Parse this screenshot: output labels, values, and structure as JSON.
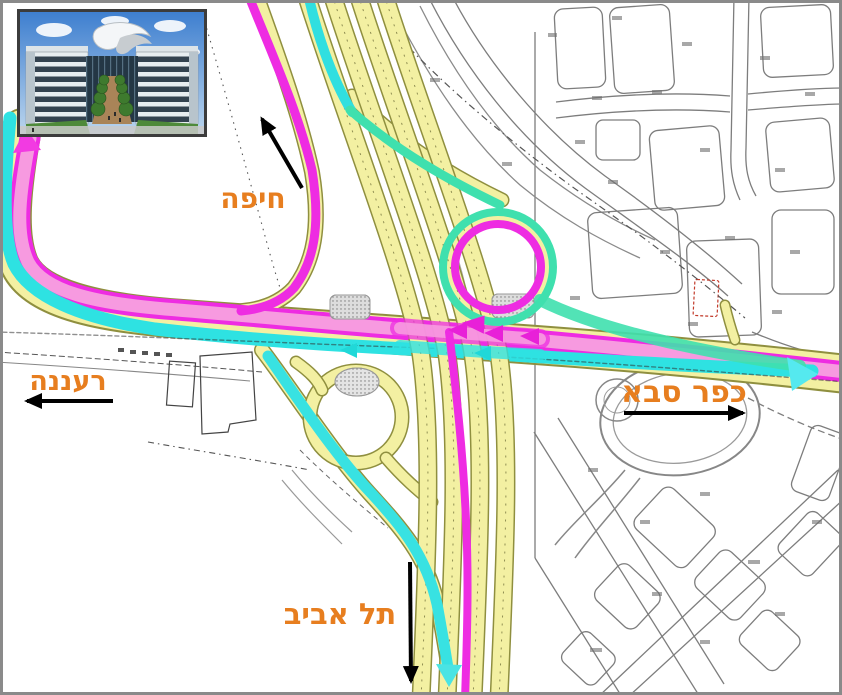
{
  "map": {
    "labels": {
      "haifa": "חיפה",
      "raanana": "רעננה",
      "kfar_saba": "כפר סבא",
      "tel_aviv": "תל אביב"
    },
    "colors": {
      "label_orange": "#E77E1F",
      "route_magenta": "#EE2CE2",
      "route_pink_fill": "#F79AE0",
      "route_cyan": "#2EE2E2",
      "route_teal": "#3FE0AE",
      "road_yellow": "#F3F0A2",
      "road_casing_olive": "#8F8F3F",
      "cad_gray": "#7D7D7D",
      "arrow_black": "#000000"
    },
    "inset": {
      "building_photo_alt": "office building rendering"
    }
  }
}
